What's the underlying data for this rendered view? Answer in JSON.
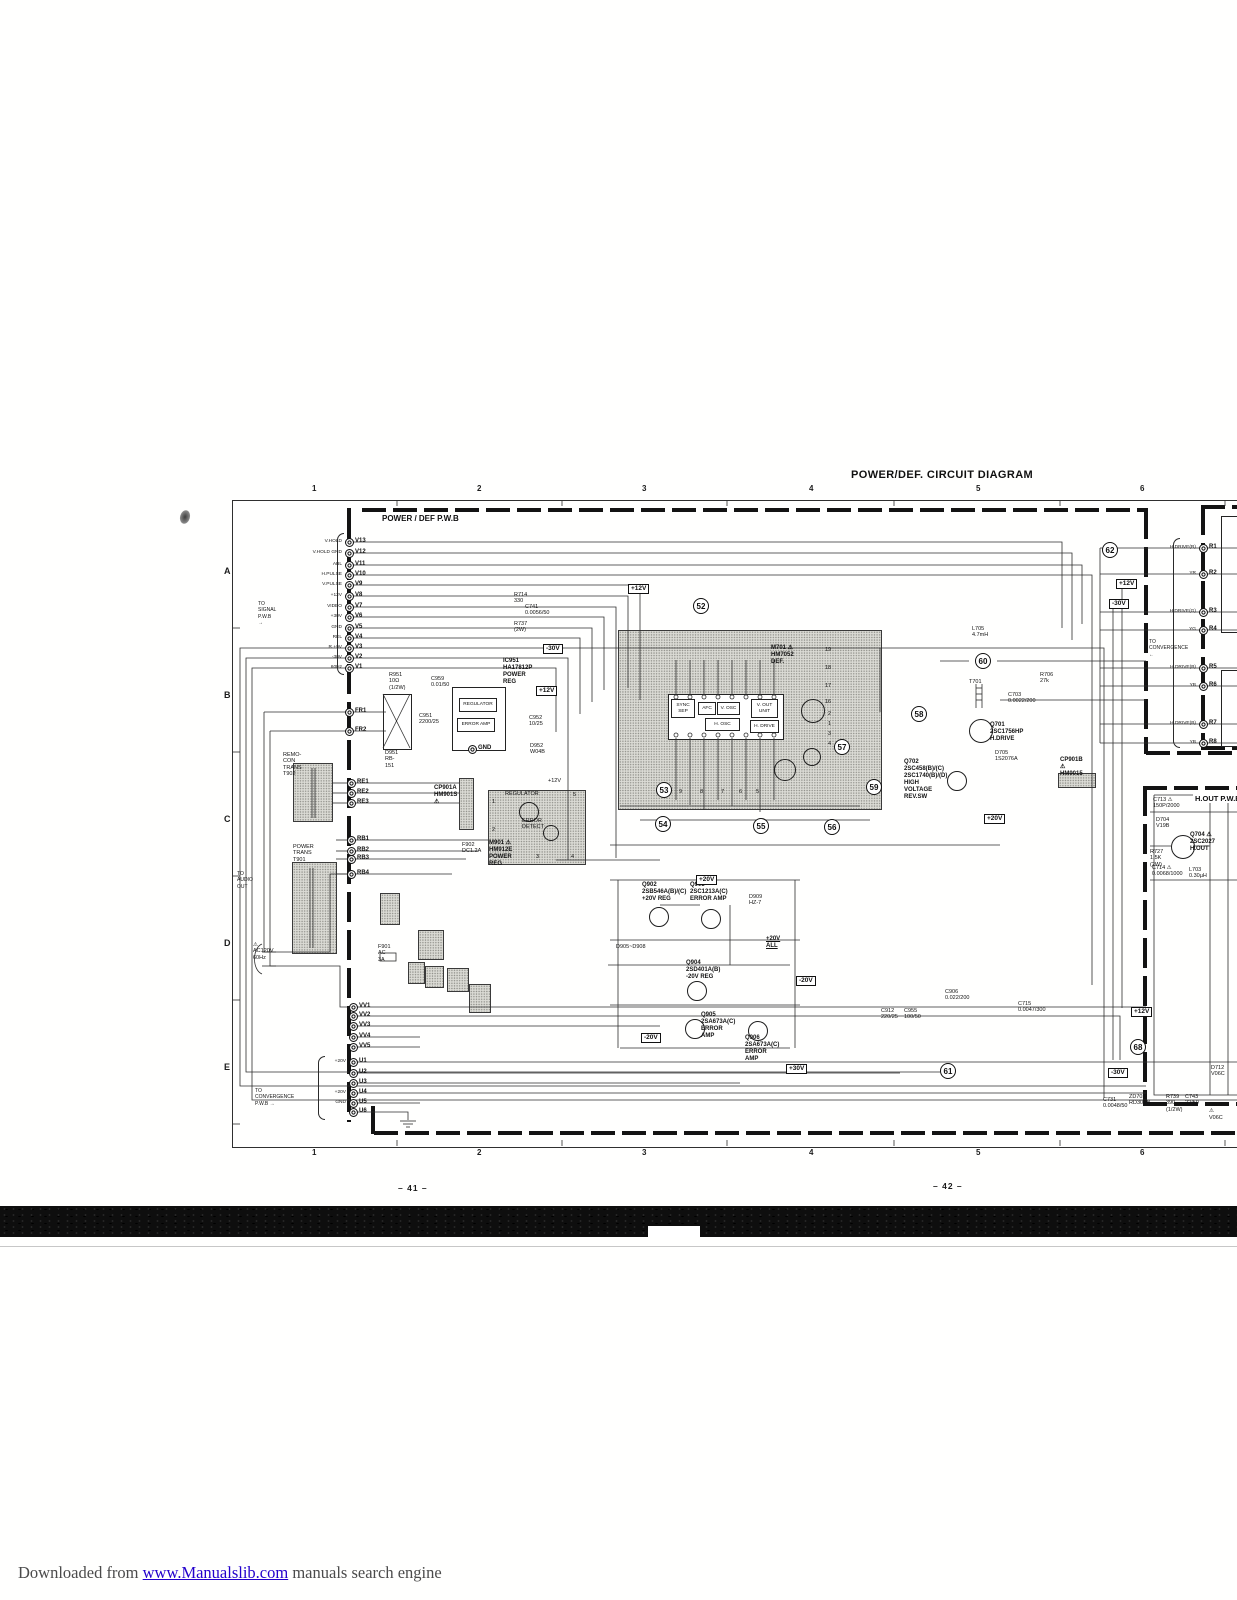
{
  "title": "POWER/DEF. CIRCUIT DIAGRAM",
  "boards": {
    "main_label": "POWER / DEF  P.W.B",
    "hout_label": "H.OUT  P.W.B"
  },
  "frame": {
    "top_ticks": [
      "1",
      "2",
      "3",
      "4",
      "5",
      "6"
    ],
    "bottom_ticks": [
      "1",
      "2",
      "3",
      "4",
      "5",
      "6"
    ],
    "row_letters": [
      "A",
      "B",
      "C",
      "D",
      "E"
    ]
  },
  "page_numbers": {
    "left": "– 41 –",
    "right": "– 42 –"
  },
  "footer": {
    "prefix": "Downloaded from ",
    "link": "www.Manualslib.com",
    "suffix": " manuals search engine"
  },
  "notes": [
    {
      "t": "TO SIGNAL  P.W.B  →",
      "x": 258,
      "y": 601
    },
    {
      "t": "TO CONVERGENCE  P.W.B  →",
      "x": 255,
      "y": 1088
    },
    {
      "t": "TO\nCONVERGENCE\n←",
      "x": 1149,
      "y": 639
    },
    {
      "t": "TO\nAUDIO OUT",
      "x": 237,
      "y": 871
    }
  ],
  "voltage_tags": [
    {
      "t": "+12V",
      "x": 628,
      "y": 584
    },
    {
      "t": "-30V",
      "x": 543,
      "y": 644
    },
    {
      "t": "+12V",
      "x": 536,
      "y": 686
    },
    {
      "t": "+12V",
      "x": 1116,
      "y": 579
    },
    {
      "t": "-30V",
      "x": 1109,
      "y": 599
    },
    {
      "t": "+20V",
      "x": 696,
      "y": 875
    },
    {
      "t": "-20V",
      "x": 796,
      "y": 976
    },
    {
      "t": "+12V",
      "x": 1131,
      "y": 1007
    },
    {
      "t": "-30V",
      "x": 1108,
      "y": 1068
    },
    {
      "t": "-20V",
      "x": 641,
      "y": 1033
    },
    {
      "t": "+20V",
      "x": 984,
      "y": 814
    },
    {
      "t": "+30V",
      "x": 786,
      "y": 1064
    }
  ],
  "circled": [
    {
      "n": "52",
      "x": 701,
      "y": 606
    },
    {
      "n": "53",
      "x": 664,
      "y": 790
    },
    {
      "n": "54",
      "x": 663,
      "y": 824
    },
    {
      "n": "55",
      "x": 761,
      "y": 826
    },
    {
      "n": "56",
      "x": 832,
      "y": 827
    },
    {
      "n": "57",
      "x": 842,
      "y": 747
    },
    {
      "n": "58",
      "x": 919,
      "y": 714
    },
    {
      "n": "59",
      "x": 874,
      "y": 787
    },
    {
      "n": "60",
      "x": 983,
      "y": 661
    },
    {
      "n": "61",
      "x": 948,
      "y": 1071
    },
    {
      "n": "62",
      "x": 1110,
      "y": 550
    },
    {
      "n": "68",
      "x": 1138,
      "y": 1047
    }
  ],
  "fboxes": [
    {
      "t": "REGULATOR",
      "x": 459,
      "y": 698,
      "w": 36,
      "h": 12
    },
    {
      "t": "ERROR AMP",
      "x": 457,
      "y": 718,
      "w": 36,
      "h": 12
    },
    {
      "t": "SYNC\nSEP",
      "x": 671,
      "y": 699,
      "w": 22,
      "h": 17
    },
    {
      "t": "AFC",
      "x": 698,
      "y": 702,
      "w": 16,
      "h": 11
    },
    {
      "t": "V. OSC",
      "x": 717,
      "y": 702,
      "w": 21,
      "h": 11
    },
    {
      "t": "V. OUT\nUNIT",
      "x": 751,
      "y": 699,
      "w": 25,
      "h": 17
    },
    {
      "t": "H. OSC",
      "x": 705,
      "y": 718,
      "w": 33,
      "h": 11
    },
    {
      "t": "H. DRIVE",
      "x": 750,
      "y": 720,
      "w": 27,
      "h": 11
    }
  ],
  "labels": [
    {
      "t": "IC951\nHA17812P\nPOWER REG",
      "x": 503,
      "y": 658,
      "b": 1
    },
    {
      "t": "D951\nRB-151",
      "x": 385,
      "y": 750
    },
    {
      "t": "R951\n10Ω\n(1/2W)",
      "x": 389,
      "y": 672
    },
    {
      "t": "C959\n0.01/50",
      "x": 431,
      "y": 676
    },
    {
      "t": "C951\n2200/25",
      "x": 419,
      "y": 713
    },
    {
      "t": "C952\n10/25",
      "x": 529,
      "y": 715
    },
    {
      "t": "D952\nW04B",
      "x": 530,
      "y": 743
    },
    {
      "t": "REMO-CON TRANS\nT902",
      "x": 283,
      "y": 752
    },
    {
      "t": "POWER TRANS\nT901",
      "x": 293,
      "y": 844
    },
    {
      "t": "CP901A\nHM901S ⚠",
      "x": 434,
      "y": 785,
      "b": 1
    },
    {
      "t": "M901 ⚠\nHM912E\nPOWER REG",
      "x": 489,
      "y": 840,
      "b": 1
    },
    {
      "t": "REGULATOR",
      "x": 505,
      "y": 791
    },
    {
      "t": "ERROR\nDETECT",
      "x": 522,
      "y": 818
    },
    {
      "t": "F902\nDC1.2A",
      "x": 462,
      "y": 842
    },
    {
      "t": "F901\nAC 3A",
      "x": 378,
      "y": 944
    },
    {
      "t": "⚠\nAC120V\n60Hz",
      "x": 253,
      "y": 942
    },
    {
      "t": "+12V",
      "x": 548,
      "y": 778
    },
    {
      "t": "M701 ⚠\nHM7052\nDEF.",
      "x": 771,
      "y": 645,
      "b": 1
    },
    {
      "t": "Q701\n2SC1756HP\nH.DRIVE",
      "x": 990,
      "y": 722,
      "b": 1
    },
    {
      "t": "T701",
      "x": 969,
      "y": 679
    },
    {
      "t": "C703\n0.0022/200",
      "x": 1008,
      "y": 692
    },
    {
      "t": "R706\n27k",
      "x": 1040,
      "y": 672
    },
    {
      "t": "L705\n4.7mH",
      "x": 972,
      "y": 626
    },
    {
      "t": "Q702\n2SC458(B)/(C)\n2SC1740(B)/(D)\nHIGH VOLTAGE\nREV.SW",
      "x": 904,
      "y": 759,
      "b": 1
    },
    {
      "t": "D705\n1S2076A",
      "x": 995,
      "y": 750
    },
    {
      "t": "CP901B ⚠\nHM9015",
      "x": 1060,
      "y": 757,
      "b": 1
    },
    {
      "t": "Q704 ⚠\n2SC2027\nH.OUT",
      "x": 1190,
      "y": 832,
      "b": 1
    },
    {
      "t": "C713 ⚠\n150P/2000",
      "x": 1153,
      "y": 797
    },
    {
      "t": "D704\nV19B",
      "x": 1156,
      "y": 817
    },
    {
      "t": "R727\n1.5K\n(2W)",
      "x": 1150,
      "y": 849
    },
    {
      "t": "C714 ⚠\n0.0068/1000",
      "x": 1152,
      "y": 865
    },
    {
      "t": "L703\n0.30µH",
      "x": 1189,
      "y": 867
    },
    {
      "t": "Q902\n2SB546A(B)/(C)\n+20V REG",
      "x": 642,
      "y": 882,
      "b": 1
    },
    {
      "t": "Q903\n2SC1213A(C)\nERROR AMP",
      "x": 690,
      "y": 882,
      "b": 1
    },
    {
      "t": "Q904\n2SD401A(B)\n-20V REG",
      "x": 686,
      "y": 960,
      "b": 1
    },
    {
      "t": "Q905\n2SA673A(C)\nERROR AMP",
      "x": 701,
      "y": 1012,
      "b": 1
    },
    {
      "t": "Q906\n2SA673A(C)\nERROR AMP",
      "x": 745,
      "y": 1035,
      "b": 1
    },
    {
      "t": "D905~D908",
      "x": 616,
      "y": 944
    },
    {
      "t": "+20V ALL",
      "x": 766,
      "y": 936,
      "b": 1,
      "u": 1
    },
    {
      "t": "D909\nHZ-7",
      "x": 749,
      "y": 894
    },
    {
      "t": "ZD702\nRD30EB",
      "x": 1129,
      "y": 1094
    },
    {
      "t": "R739\n390\n(1/2W)",
      "x": 1166,
      "y": 1094
    },
    {
      "t": "C743\n22/50",
      "x": 1185,
      "y": 1094
    },
    {
      "t": "C731\n0.0048/50",
      "x": 1103,
      "y": 1097
    },
    {
      "t": "D712\nV06C",
      "x": 1211,
      "y": 1065
    },
    {
      "t": "D708 ⚠\nV06C",
      "x": 1209,
      "y": 1102
    },
    {
      "t": "R714\n330",
      "x": 514,
      "y": 592
    },
    {
      "t": "C741\n0.0056/50",
      "x": 525,
      "y": 604
    },
    {
      "t": "R737\n(2W)",
      "x": 514,
      "y": 621
    },
    {
      "t": "C715\n0.0047/300",
      "x": 1018,
      "y": 1001
    },
    {
      "t": "C906\n0.022/200",
      "x": 945,
      "y": 989
    },
    {
      "t": "C912\n220/25",
      "x": 881,
      "y": 1008
    },
    {
      "t": "C955\n100/50",
      "x": 904,
      "y": 1008
    },
    {
      "t": "19",
      "x": 825,
      "y": 647
    },
    {
      "t": "18",
      "x": 825,
      "y": 665
    },
    {
      "t": "17",
      "x": 825,
      "y": 683
    },
    {
      "t": "16",
      "x": 825,
      "y": 699
    },
    {
      "t": "2",
      "x": 828,
      "y": 711
    },
    {
      "t": "1",
      "x": 828,
      "y": 721
    },
    {
      "t": "3",
      "x": 828,
      "y": 731
    },
    {
      "t": "4",
      "x": 828,
      "y": 741
    },
    {
      "t": "9",
      "x": 679,
      "y": 789
    },
    {
      "t": "8",
      "x": 700,
      "y": 789
    },
    {
      "t": "7",
      "x": 721,
      "y": 789
    },
    {
      "t": "6",
      "x": 739,
      "y": 789
    },
    {
      "t": "5",
      "x": 756,
      "y": 789
    },
    {
      "t": "1",
      "x": 492,
      "y": 799
    },
    {
      "t": "2",
      "x": 492,
      "y": 827
    },
    {
      "t": "5",
      "x": 573,
      "y": 792
    },
    {
      "t": "3",
      "x": 536,
      "y": 854
    },
    {
      "t": "4",
      "x": 571,
      "y": 854
    }
  ],
  "pins": [
    {
      "n": "V13",
      "s": "V.HOLD",
      "x": 349,
      "y": 542
    },
    {
      "n": "V12",
      "s": "V.HOLD GND",
      "x": 349,
      "y": 553
    },
    {
      "n": "V11",
      "s": "ABL",
      "x": 349,
      "y": 565
    },
    {
      "n": "V10",
      "s": "H.PULSE",
      "x": 349,
      "y": 575
    },
    {
      "n": "V9",
      "s": "V.PULSE",
      "x": 349,
      "y": 585
    },
    {
      "n": "V8",
      "s": "+12V",
      "x": 349,
      "y": 596
    },
    {
      "n": "V7",
      "s": "VIDEO",
      "x": 349,
      "y": 607
    },
    {
      "n": "V6",
      "s": "+30V",
      "x": 349,
      "y": 617
    },
    {
      "n": "V5",
      "s": "GND",
      "x": 349,
      "y": 628
    },
    {
      "n": "V4",
      "s": "REL",
      "x": 349,
      "y": 638
    },
    {
      "n": "V3",
      "s": "R.+9V",
      "x": 349,
      "y": 648
    },
    {
      "n": "V2",
      "s": "-30V",
      "x": 349,
      "y": 658
    },
    {
      "n": "V1",
      "s": "60Hz",
      "x": 349,
      "y": 668
    },
    {
      "n": "FR1",
      "x": 349,
      "y": 712
    },
    {
      "n": "FR2",
      "x": 349,
      "y": 731
    },
    {
      "n": "RE1",
      "x": 351,
      "y": 783
    },
    {
      "n": "RE2",
      "x": 351,
      "y": 793
    },
    {
      "n": "RE3",
      "x": 351,
      "y": 803
    },
    {
      "n": "RB1",
      "x": 351,
      "y": 840
    },
    {
      "n": "RB2",
      "x": 351,
      "y": 851
    },
    {
      "n": "RB3",
      "x": 351,
      "y": 859
    },
    {
      "n": "RB4",
      "x": 351,
      "y": 874
    },
    {
      "n": "GND",
      "x": 472,
      "y": 749
    },
    {
      "n": "VV1",
      "x": 353,
      "y": 1007
    },
    {
      "n": "VV2",
      "x": 353,
      "y": 1016
    },
    {
      "n": "VV3",
      "x": 353,
      "y": 1026
    },
    {
      "n": "VV4",
      "x": 353,
      "y": 1037
    },
    {
      "n": "VV5",
      "x": 353,
      "y": 1047
    },
    {
      "n": "U1",
      "s": "+20V",
      "x": 353,
      "y": 1062
    },
    {
      "n": "U2",
      "x": 353,
      "y": 1073
    },
    {
      "n": "U3",
      "x": 353,
      "y": 1083
    },
    {
      "n": "U4",
      "s": "+20V",
      "x": 353,
      "y": 1093
    },
    {
      "n": "U5",
      "s": "GND",
      "x": 353,
      "y": 1103
    },
    {
      "n": "U6",
      "x": 353,
      "y": 1112
    },
    {
      "n": "R1",
      "s": "H.DRIVE(R)",
      "x": 1203,
      "y": 548
    },
    {
      "n": "R2",
      "s": "YR",
      "x": 1203,
      "y": 574
    },
    {
      "n": "R3",
      "s": "H.DRIVE(G)",
      "x": 1203,
      "y": 612
    },
    {
      "n": "R4",
      "s": "YG",
      "x": 1203,
      "y": 630
    },
    {
      "n": "R5",
      "s": "H.DRIVE(B)",
      "x": 1203,
      "y": 668
    },
    {
      "n": "R6",
      "s": "YB",
      "x": 1203,
      "y": 686
    },
    {
      "n": "R7",
      "s": "H.DRIVE(B)",
      "x": 1203,
      "y": 724
    },
    {
      "n": "R8",
      "s": "YB",
      "x": 1203,
      "y": 743
    }
  ]
}
